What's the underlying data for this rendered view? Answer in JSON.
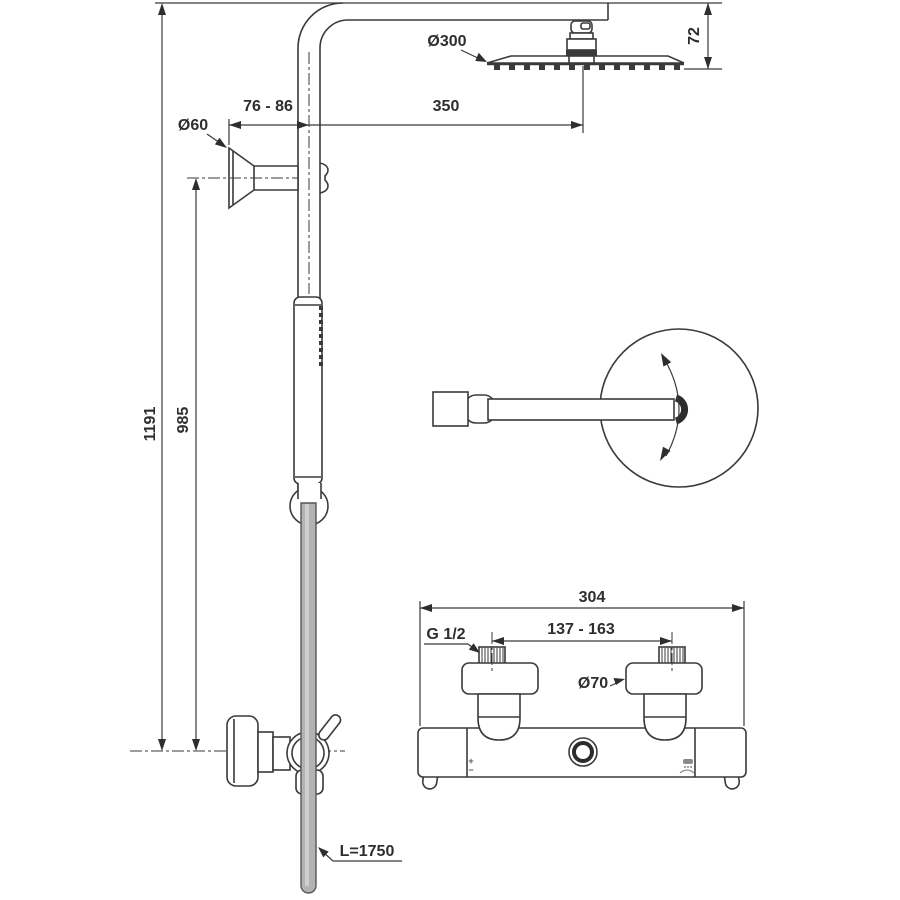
{
  "drawing": {
    "type": "technical-dimension-drawing",
    "subject": "thermostatic shower system with rain head, hand shower and exposed mixer",
    "background": "#ffffff",
    "line_color": "#3a3a3a",
    "hose_color": "#b3b3b3"
  },
  "labels": {
    "total_height": "1191",
    "riser_height": "985",
    "head_diameter": "Ø300",
    "arm_length": "350",
    "bracket_offset": "76 - 86",
    "bracket_diameter": "Ø60",
    "head_drop": "72",
    "hose_length": "L=1750",
    "valve_width": "304",
    "inlet_spacing": "137 - 163",
    "inlet_thread": "G 1/2",
    "handle_diameter": "Ø70",
    "temp_plus": "+",
    "temp_minus": "−"
  }
}
